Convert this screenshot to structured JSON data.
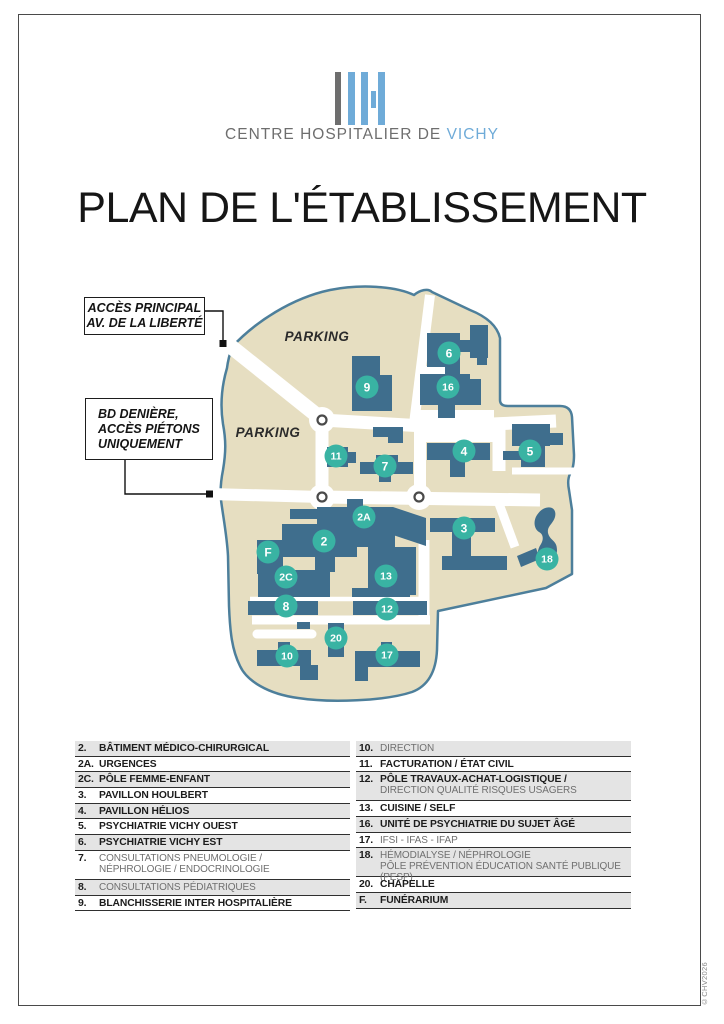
{
  "logo": {
    "name_gray": "CENTRE HOSPITALIER DE ",
    "name_blue": "VICHY",
    "colors": {
      "blue": "#6fabd8",
      "gray": "#6e6e6e"
    }
  },
  "title": "PLAN DE L'ÉTABLISSEMENT",
  "copyright": "©CHV2026",
  "callouts": [
    {
      "lines": [
        "ACCÈS PRINCIPAL",
        "AV. DE LA LIBERTÉ"
      ]
    },
    {
      "lines": [
        "BD DENIÈRE,",
        "ACCÈS PIÉTONS",
        "UNIQUEMENT"
      ]
    }
  ],
  "map": {
    "colors": {
      "land": "#e6dec1",
      "outline": "#4d7f9b",
      "building": "#3f6e8d",
      "marker": "#39b3a3",
      "road": "#ffffff"
    },
    "parking_labels": [
      {
        "text": "PARKING",
        "x": 317,
        "y": 341
      },
      {
        "text": "PARKING",
        "x": 268,
        "y": 437
      }
    ],
    "markers": [
      {
        "label": "6",
        "x": 449,
        "y": 353
      },
      {
        "label": "9",
        "x": 367,
        "y": 387
      },
      {
        "label": "16",
        "x": 448,
        "y": 387
      },
      {
        "label": "11",
        "x": 336,
        "y": 456
      },
      {
        "label": "7",
        "x": 385,
        "y": 466
      },
      {
        "label": "4",
        "x": 464,
        "y": 451
      },
      {
        "label": "5",
        "x": 530,
        "y": 451
      },
      {
        "label": "2A",
        "x": 364,
        "y": 517
      },
      {
        "label": "2",
        "x": 324,
        "y": 541
      },
      {
        "label": "3",
        "x": 464,
        "y": 528
      },
      {
        "label": "F",
        "x": 268,
        "y": 552
      },
      {
        "label": "18",
        "x": 547,
        "y": 559
      },
      {
        "label": "2C",
        "x": 286,
        "y": 577
      },
      {
        "label": "13",
        "x": 386,
        "y": 576
      },
      {
        "label": "8",
        "x": 286,
        "y": 606
      },
      {
        "label": "12",
        "x": 387,
        "y": 609
      },
      {
        "label": "20",
        "x": 336,
        "y": 638
      },
      {
        "label": "10",
        "x": 287,
        "y": 656
      },
      {
        "label": "17",
        "x": 387,
        "y": 655
      }
    ]
  },
  "legend": {
    "left": [
      {
        "num": "2.",
        "label": "BÂTIMENT MÉDICO-CHIRURGICAL"
      },
      {
        "num": "2A.",
        "label": "URGENCES"
      },
      {
        "num": "2C.",
        "label": "PÔLE FEMME-ENFANT"
      },
      {
        "num": "3.",
        "label": "PAVILLON HOULBERT"
      },
      {
        "num": "4.",
        "label": "PAVILLON HÉLIOS"
      },
      {
        "num": "5.",
        "label": "PSYCHIATRIE VICHY OUEST"
      },
      {
        "num": "6.",
        "label": "PSYCHIATRIE VICHY EST"
      },
      {
        "num": "7.",
        "label": "CONSULTATIONS PNEUMOLOGIE /",
        "label2": "NÉPHROLOGIE / ENDOCRINOLOGIE",
        "muted": true
      },
      {
        "num": "8.",
        "label": "CONSULTATIONS PÉDIATRIQUES",
        "muted": true
      },
      {
        "num": "9.",
        "label": "BLANCHISSERIE INTER HOSPITALIÈRE"
      }
    ],
    "right": [
      {
        "num": "10.",
        "label": "DIRECTION",
        "muted": true
      },
      {
        "num": "11.",
        "label": "FACTURATION / ÉTAT CIVIL"
      },
      {
        "num": "12.",
        "label": "PÔLE TRAVAUX-ACHAT-LOGISTIQUE /",
        "label2": "DIRECTION QUALITÉ RISQUES USAGERS",
        "label2_muted": true
      },
      {
        "num": "13.",
        "label": "CUISINE / SELF"
      },
      {
        "num": "16.",
        "label": "UNITÉ DE PSYCHIATRIE DU SUJET ÂGÉ"
      },
      {
        "num": "17.",
        "label": "IFSI - IFAS - IFAP",
        "muted": true
      },
      {
        "num": "18.",
        "label": "HÉMODIALYSE / NÉPHROLOGIE",
        "label2": "PÔLE PRÉVENTION ÉDUCATION SANTÉ PUBLIQUE (PESP)",
        "muted": true
      },
      {
        "num": "20.",
        "label": "CHAPELLE"
      },
      {
        "num": "F.",
        "label": "FUNÉRARIUM"
      }
    ]
  }
}
